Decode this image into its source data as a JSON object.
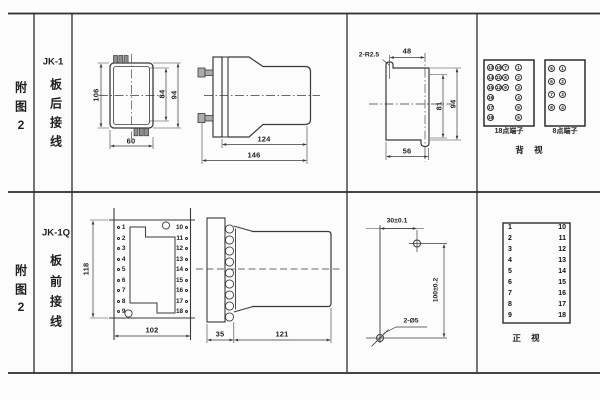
{
  "colors": {
    "ink": "#3a3a3a",
    "frame": "#2d2d2d",
    "background": "#fcfcfc"
  },
  "row1": {
    "figure_label": {
      "char1": "附",
      "char2": "图",
      "char3": "2"
    },
    "model": "JK-1",
    "wiring": {
      "char1": "板",
      "char2": "后",
      "char3": "接",
      "char4": "线"
    },
    "rear_outline_view": {
      "dim_height": "106",
      "dim_width": "60",
      "dim_inner_height": "84",
      "dim_outer_height": "94"
    },
    "side_view": {
      "dim_body": "124",
      "dim_total": "146"
    },
    "panel_cutout_view": {
      "note_radius": "2-R2.5",
      "dim_top": "48",
      "dim_inner_height": "81",
      "dim_outer_height": "94",
      "dim_bottom": "56"
    },
    "terminal_18": {
      "label": "18点端子",
      "col1": [
        "13",
        "14",
        "15",
        "16",
        "17",
        "18"
      ],
      "col2": [
        "10",
        "11",
        "12"
      ],
      "col3": [
        "7",
        "8",
        "9"
      ],
      "col4": [
        "1",
        "2",
        "3",
        "4",
        "5",
        "6"
      ]
    },
    "terminal_8": {
      "label": "8点端子",
      "left": [
        "5",
        "6",
        "7",
        "8"
      ],
      "right": [
        "1",
        "2",
        "3",
        "4"
      ]
    },
    "view_label": "背 视"
  },
  "row2": {
    "figure_label": {
      "char1": "附",
      "char2": "图",
      "char3": "2"
    },
    "model": "JK-1Q",
    "wiring": {
      "char1": "板",
      "char2": "前",
      "char3": "接",
      "char4": "线"
    },
    "front_view": {
      "dim_height": "118",
      "dim_width": "102",
      "left_terminals": [
        "1",
        "2",
        "3",
        "4",
        "5",
        "6",
        "7",
        "8",
        "9"
      ],
      "right_terminals": [
        "10",
        "11",
        "12",
        "13",
        "14",
        "15",
        "16",
        "17",
        "18"
      ]
    },
    "side_view": {
      "dim_flange": "35",
      "dim_body": "121"
    },
    "drill_view": {
      "dim_width": "30±0.1",
      "dim_height": "100±0.2",
      "note_holes": "2-Ø5"
    },
    "terminal_table": {
      "left": [
        "1",
        "2",
        "3",
        "4",
        "5",
        "6",
        "7",
        "8",
        "9"
      ],
      "right": [
        "10",
        "11",
        "12",
        "13",
        "14",
        "15",
        "16",
        "17",
        "18"
      ],
      "view_label": "正 视"
    }
  }
}
